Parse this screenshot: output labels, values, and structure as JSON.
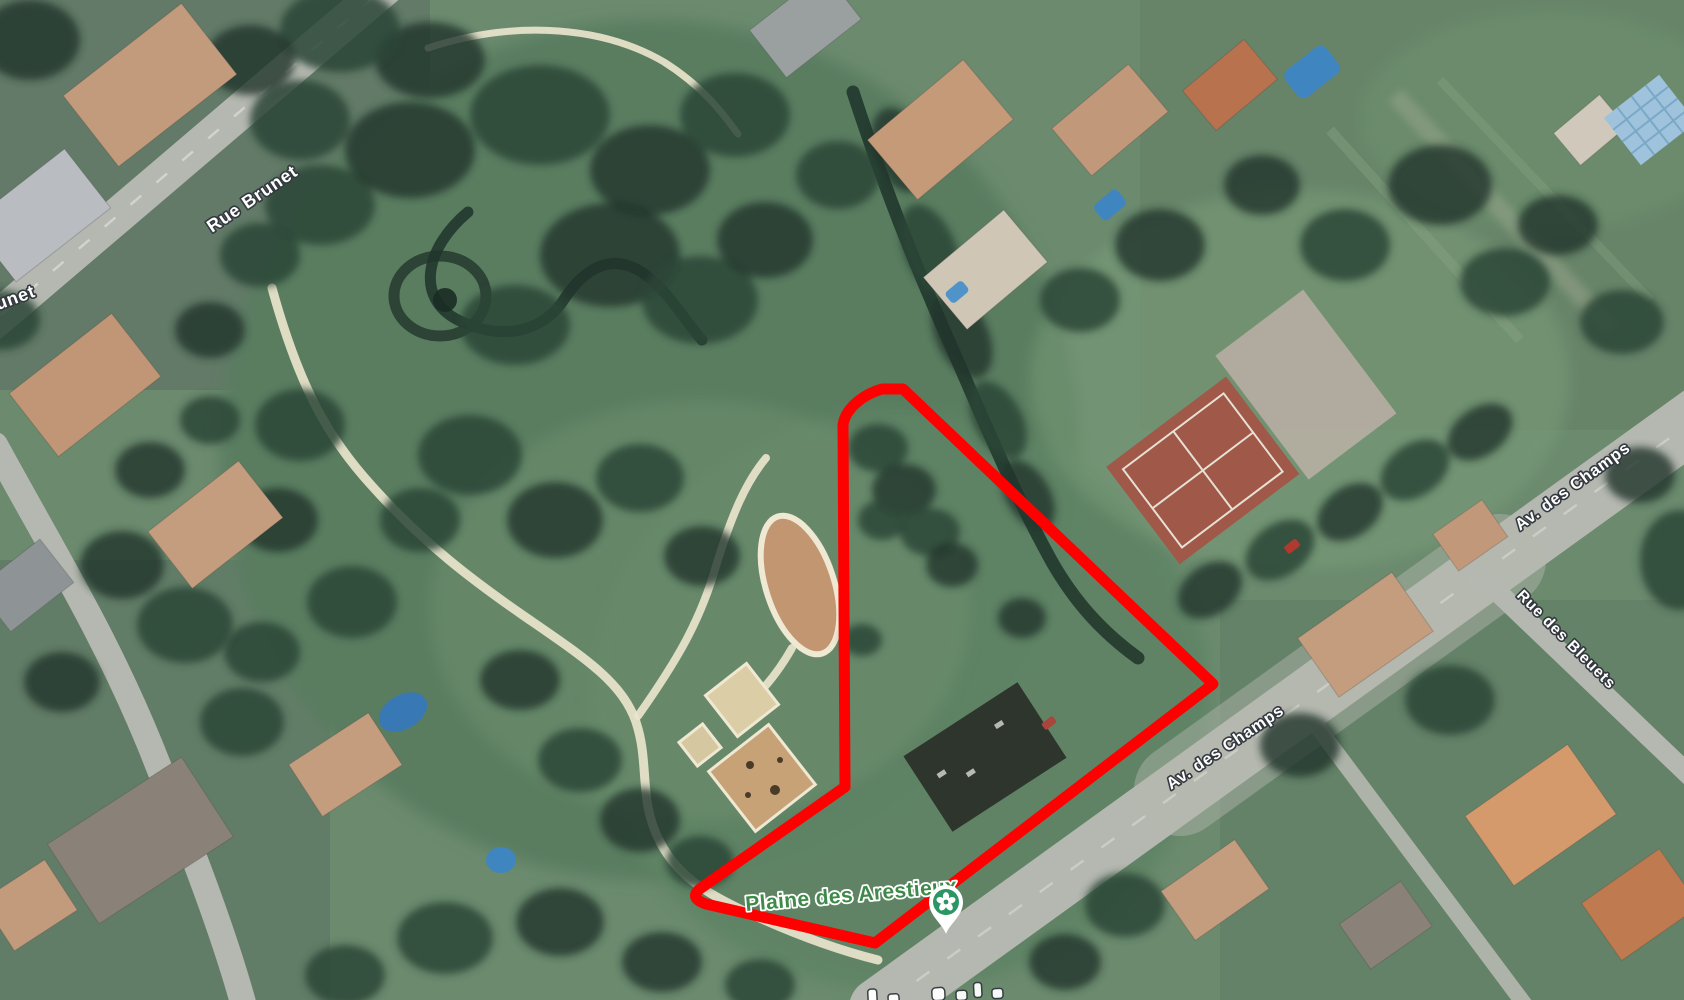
{
  "map": {
    "view": "satellite",
    "street_labels": [
      {
        "id": "rue-brunet",
        "text": "Rue Brunet"
      },
      {
        "id": "rue-brunet-partial",
        "text": "Rue Brunet"
      },
      {
        "id": "av-des-champs-upper",
        "text": "Av. des Champs"
      },
      {
        "id": "av-des-champs-lower",
        "text": "Av. des Champs"
      },
      {
        "id": "rue-des-bleuets",
        "text": "Rue des Bleuets"
      }
    ],
    "place": {
      "label": "Plaine des Arestieux",
      "icon": "park-pin-flower-icon"
    },
    "overlay": {
      "shape": "polygon-outline",
      "path": "M903,389 L1213,684 L875,943 L706,904 Q688,898 701,888 L845,787 L843,425 C845,410 861,395 882,389 Z",
      "stroke": "#ff0000",
      "stroke_width": "11"
    },
    "colors": {
      "street_label_fill": "#ffffff",
      "street_label_outline": "#33393f",
      "place_label_fill": "#3f8a4a",
      "place_label_halo": "#ffffff",
      "poi_pin_green": "#2a9664",
      "road_gray": "#b5b8b0",
      "grass_green": "#6b8a6e",
      "tree_green": "#2c4637",
      "water_channel": "#20352b",
      "sand_tan": "#c9a47c",
      "park_path_cream": "#eae4cd",
      "tennis_clay": "#a05848",
      "pool_blue": "#3879b5",
      "overlay_red": "#ff0000"
    }
  }
}
